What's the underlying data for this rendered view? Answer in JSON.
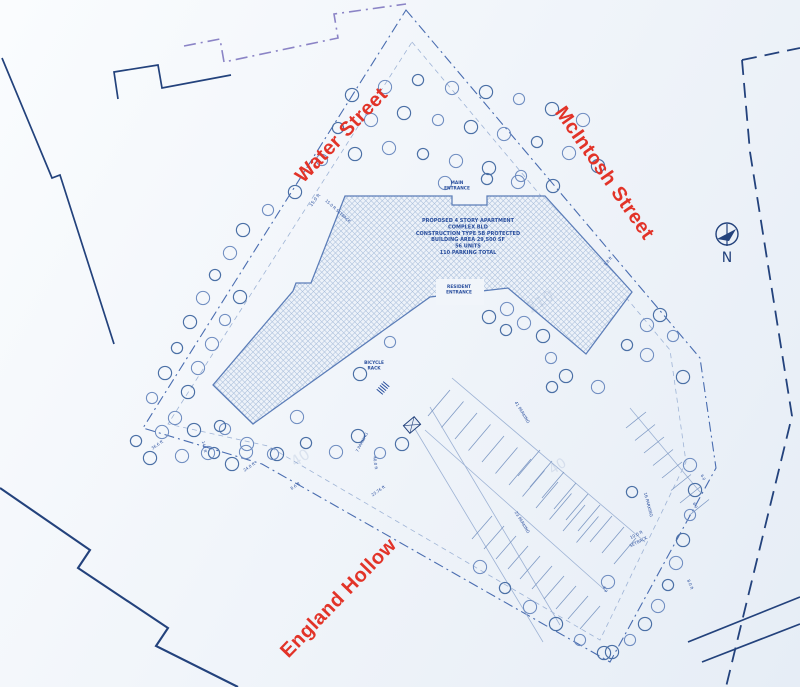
{
  "streets": [
    {
      "name": "Water Street"
    },
    {
      "name": "McIntosh Street"
    },
    {
      "name": "England Hollow"
    }
  ],
  "north": {
    "label": "N"
  },
  "building": {
    "path": "M345,196 L452,196 L452,205 L487,205 L487,196 L545,196 L632,292 L586,354 L508,288 L430,297 L253,424 L213,385 L293,291 L296,283 L311,283 Z",
    "info": {
      "x": 468,
      "y": 222,
      "lines": [
        "PROPOSED 4 STORY APARTMENT",
        "COMPLEX BLD",
        "CONSTRUCTION TYPE 5B PROTECTED",
        "BUILDING AREA 29,500 SF",
        "56 UNITS",
        "110 PARKING TOTAL"
      ]
    }
  },
  "entrances": [
    {
      "lines": [
        "MAIN",
        "ENTRANCE"
      ],
      "x": 457,
      "y": 184
    },
    {
      "lines": [
        "RESIDENT",
        "ENTRANCE"
      ],
      "x": 459,
      "y": 288
    }
  ],
  "bicycle": {
    "lines": [
      "BICYCLE",
      "RACK"
    ],
    "x": 374,
    "y": 364
  },
  "annotations": [
    {
      "text": "15.0 ft",
      "x": 316,
      "y": 201,
      "rot": -52,
      "size": 4.5
    },
    {
      "text": "15.0 ft SETBACK",
      "x": 337,
      "y": 212,
      "rot": 42,
      "size": 4
    },
    {
      "text": "1.8 ft",
      "x": 609,
      "y": 262,
      "rot": -50,
      "size": 4
    },
    {
      "text": "36.6 ft",
      "x": 158,
      "y": 446,
      "rot": -35,
      "size": 4
    },
    {
      "text": "147 ft",
      "x": 203,
      "y": 447,
      "rot": 78,
      "size": 4
    },
    {
      "text": "24.0 ft",
      "x": 250,
      "y": 468,
      "rot": -35,
      "size": 4
    },
    {
      "text": "8.6 ft",
      "x": 296,
      "y": 487,
      "rot": -35,
      "size": 4
    },
    {
      "text": "7 PARKING",
      "x": 363,
      "y": 443,
      "rot": -62,
      "size": 4
    },
    {
      "text": "40.0 ft",
      "x": 374,
      "y": 463,
      "rot": 82,
      "size": 4
    },
    {
      "text": "23.76 ft",
      "x": 379,
      "y": 492,
      "rot": -35,
      "size": 4
    },
    {
      "text": "41 PARKING",
      "x": 521,
      "y": 413,
      "rot": 58,
      "size": 4.2
    },
    {
      "text": "23 PARKING",
      "x": 521,
      "y": 523,
      "rot": 58,
      "size": 4.2
    },
    {
      "text": "16 PARKING",
      "x": 647,
      "y": 505,
      "rot": 75,
      "size": 4.2
    },
    {
      "text": "10.0 ft",
      "x": 637,
      "y": 536,
      "rot": -27,
      "size": 4.2
    },
    {
      "text": "SETBACK",
      "x": 639,
      "y": 543,
      "rot": -27,
      "size": 4.2
    },
    {
      "text": "8.0 ft",
      "x": 689,
      "y": 585,
      "rot": 68,
      "size": 4
    },
    {
      "text": "6.0",
      "x": 702,
      "y": 478,
      "rot": 60,
      "size": 3.8
    },
    {
      "text": "6.0",
      "x": 694,
      "y": 506,
      "rot": 60,
      "size": 3.8
    },
    {
      "text": "6.0",
      "x": 604,
      "y": 590,
      "rot": 60,
      "size": 3.8
    },
    {
      "text": "210",
      "x": 543,
      "y": 306,
      "rot": -33,
      "size": 15,
      "ghost": true
    },
    {
      "text": "40",
      "x": 303,
      "y": 462,
      "rot": -33,
      "size": 15,
      "ghost": true
    },
    {
      "text": "40",
      "x": 560,
      "y": 470,
      "rot": -33,
      "size": 14,
      "ghost": true
    }
  ],
  "boundary_lines": [
    {
      "d": "M406,10 L700,358 L716,468 L610,662 L262,464 L143,428 Z",
      "cls": "dashdot"
    },
    {
      "d": "M412,42 L670,350 L686,462 L600,640 L268,446 L168,424 Z",
      "cls": "dashfine"
    },
    {
      "d": "M184,46 L220,39 L224,62 L338,38 L334,14 L406,4",
      "cls": "dashdot-purple"
    },
    {
      "d": "M118,99 L114,72 L158,65 L162,88 L231,75",
      "cls": "solid-navy"
    },
    {
      "d": "M2,58 L52,178 L60,175 L114,344",
      "cls": "solid-navy"
    },
    {
      "d": "M0,488 L90,550 L78,568 L168,628 L156,646 L238,687",
      "cls": "solid-navy2"
    },
    {
      "d": "M742,60 L750,152 L792,416 L726,687",
      "cls": "dash-navy"
    },
    {
      "d": "M742,60 L800,48",
      "cls": "dash-navy"
    },
    {
      "d": "M688,642 L800,597",
      "cls": "solid-navy"
    },
    {
      "d": "M702,662 L800,624",
      "cls": "solid-navy"
    },
    {
      "d": "M412,424 L543,642",
      "cls": "thin"
    },
    {
      "d": "M430,407 L560,625",
      "cls": "thin"
    },
    {
      "d": "M452,378 L645,542",
      "cls": "thin"
    },
    {
      "d": "M425,430 L607,592",
      "cls": "thin"
    },
    {
      "d": "M630,408 L700,492",
      "cls": "thin"
    }
  ],
  "stripe_bands": [
    {
      "x": 450,
      "y": 390,
      "dx": 13.5,
      "dy": 11.5,
      "sx": -22,
      "sy": 26,
      "n": 12
    },
    {
      "x": 540,
      "y": 450,
      "dx": 12,
      "dy": 11,
      "sx": -22,
      "sy": 26,
      "n": 9
    },
    {
      "x": 492,
      "y": 516,
      "dx": 12,
      "dy": 10,
      "sx": -20,
      "sy": 23,
      "n": 10
    },
    {
      "x": 626,
      "y": 428,
      "dx": 9,
      "dy": 12.5,
      "sx": 20,
      "sy": -16,
      "n": 8
    }
  ],
  "trees": [
    [
      352,
      95
    ],
    [
      385,
      87
    ],
    [
      418,
      80
    ],
    [
      452,
      88
    ],
    [
      486,
      92
    ],
    [
      519,
      99
    ],
    [
      552,
      109
    ],
    [
      583,
      120
    ],
    [
      338,
      128
    ],
    [
      371,
      120
    ],
    [
      404,
      113
    ],
    [
      438,
      120
    ],
    [
      471,
      127
    ],
    [
      504,
      134
    ],
    [
      537,
      142
    ],
    [
      569,
      153
    ],
    [
      598,
      166
    ],
    [
      322,
      160
    ],
    [
      355,
      154
    ],
    [
      389,
      148
    ],
    [
      423,
      154
    ],
    [
      456,
      161
    ],
    [
      489,
      168
    ],
    [
      521,
      176
    ],
    [
      553,
      186
    ],
    [
      445,
      183
    ],
    [
      487,
      179
    ],
    [
      518,
      182
    ],
    [
      295,
      192
    ],
    [
      268,
      210
    ],
    [
      243,
      230
    ],
    [
      230,
      253
    ],
    [
      215,
      275
    ],
    [
      203,
      298
    ],
    [
      240,
      297
    ],
    [
      225,
      320
    ],
    [
      190,
      322
    ],
    [
      212,
      344
    ],
    [
      177,
      348
    ],
    [
      198,
      368
    ],
    [
      165,
      373
    ],
    [
      152,
      398
    ],
    [
      188,
      392
    ],
    [
      175,
      418
    ],
    [
      136,
      441
    ],
    [
      162,
      432
    ],
    [
      194,
      430
    ],
    [
      225,
      429
    ],
    [
      150,
      458
    ],
    [
      182,
      456
    ],
    [
      214,
      453
    ],
    [
      246,
      452
    ],
    [
      277,
      454
    ],
    [
      390,
      342
    ],
    [
      360,
      374
    ],
    [
      297,
      417
    ],
    [
      306,
      443
    ],
    [
      336,
      452
    ],
    [
      358,
      436
    ],
    [
      380,
      453
    ],
    [
      402,
      444
    ],
    [
      247,
      444
    ],
    [
      220,
      426
    ],
    [
      208,
      453
    ],
    [
      232,
      464
    ],
    [
      273,
      454
    ],
    [
      489,
      317
    ],
    [
      507,
      309
    ],
    [
      506,
      330
    ],
    [
      524,
      323
    ],
    [
      543,
      336
    ],
    [
      551,
      358
    ],
    [
      566,
      376
    ],
    [
      598,
      387
    ],
    [
      627,
      345
    ],
    [
      647,
      325
    ],
    [
      660,
      315
    ],
    [
      673,
      336
    ],
    [
      683,
      377
    ],
    [
      647,
      355
    ],
    [
      552,
      387
    ],
    [
      690,
      465
    ],
    [
      695,
      490
    ],
    [
      690,
      515
    ],
    [
      683,
      540
    ],
    [
      676,
      563
    ],
    [
      668,
      585
    ],
    [
      658,
      606
    ],
    [
      645,
      624
    ],
    [
      630,
      640
    ],
    [
      612,
      652
    ],
    [
      480,
      567
    ],
    [
      505,
      588
    ],
    [
      530,
      607
    ],
    [
      556,
      624
    ],
    [
      580,
      640
    ],
    [
      604,
      653
    ],
    [
      608,
      582
    ],
    [
      632,
      492
    ]
  ]
}
